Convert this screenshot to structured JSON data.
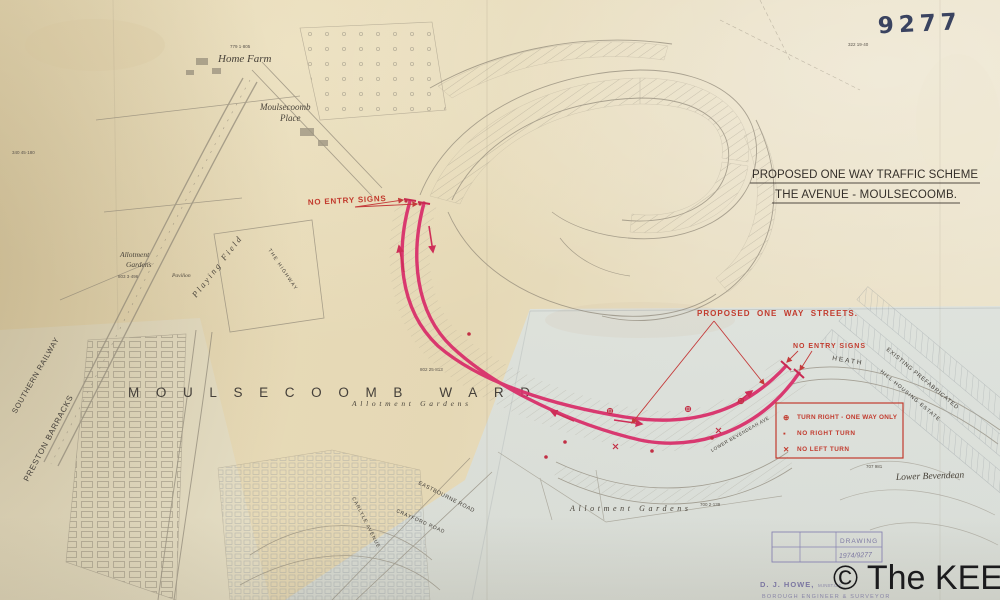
{
  "document": {
    "ref_number": "9277",
    "title": {
      "line1": "PROPOSED ONE WAY TRAFFIC SCHEME",
      "line2": "THE AVENUE - MOULSECOOMB."
    },
    "watermark": "© The KEEP"
  },
  "scheme": {
    "no_entry_left": "NO ENTRY SIGNS",
    "no_entry_right": "NO ENTRY SIGNS",
    "one_way_streets": "PROPOSED  ONE  WAY  STREETS.",
    "legend": {
      "items": [
        {
          "symbol": "⊕",
          "label": "TURN RIGHT - ONE WAY ONLY"
        },
        {
          "symbol": "▪",
          "label": "NO RIGHT TURN"
        },
        {
          "symbol": "✕",
          "label": "NO LEFT TURN"
        }
      ]
    }
  },
  "places": {
    "home_farm": "Home Farm",
    "moulsecoomb_place_1": "Moulsecoomb",
    "moulsecoomb_place_2": "Place",
    "ward": "MOULSECOOMB WARD",
    "allotment_left_1": "Allotment",
    "allotment_left_2": "Gardens",
    "allotment_mid": "Allotment Gardens",
    "allotment_bottom": "Allotment Gardens",
    "playing_field": "Playing Field",
    "pavilion": "Pavilion",
    "the_highway": "THE HIGHWAY",
    "southern_railway": "SOUTHERN RAILWAY",
    "preston_barracks": "PRESTON BARRACKS",
    "lower_bevendean": "Lower Bevendean",
    "prefab_line1": "EXISTING PREFABRICATED",
    "prefab_line2": "HILL HOUSING ESTATE",
    "heath": "HEATH",
    "eastbourne_road": "EASTBOURNE ROAD",
    "crayford_road": "CRAYFORD ROAD",
    "carlyle_avenue": "CARLYLE AVENUE",
    "bevendean_ave": "LOWER BEVENDEAN AVE"
  },
  "parcels": [
    "340 45·180",
    "779 1·805",
    "803 3·496",
    "802 25·813",
    "700 2·139",
    "707 981",
    "322 19·40"
  ],
  "footer": {
    "stamp_title": "DRAWING",
    "stamp_number": "1974/9277",
    "engineer": "D. J. HOWE,",
    "engineer_quals": "M.INST.C.E.",
    "engineer_title": "BOROUGH ENGINEER & SURVEYOR"
  },
  "colors": {
    "route_red": "#d9306b",
    "annotation_red": "#c23b2e",
    "paper_beige": "#e7dcba",
    "paper_blue": "#dfe3e1",
    "ink": "#35302a",
    "stamp_purple": "#6e689a"
  }
}
